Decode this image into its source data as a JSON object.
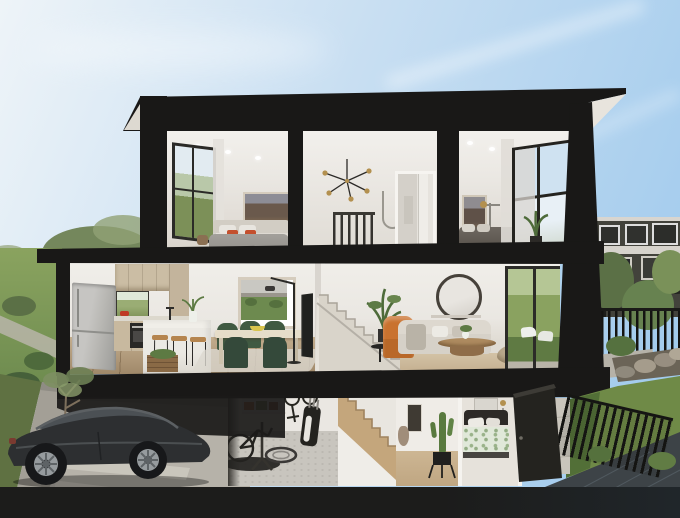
{
  "scene": {
    "type": "architectural-cutaway-render",
    "description": "Dollhouse cutaway render of a three-storey black-framed townhouse: two bedrooms and a stair landing upstairs, kitchen-dining and living room with staircase mid-level, and a garage with black sedan, bike workshop, hall and third bedroom at ground level; eucalyptus trees and driveway on the left, neighbouring dark townhouses, backyard, black slat fences and sloping lawn on the right under a clear blue sky.",
    "floors": [
      {
        "name": "upper",
        "rooms": [
          {
            "name": "main-bedroom",
            "objects": [
              "side-window",
              "landscape-artwork",
              "queen-bed",
              "white-pillows",
              "orange-accent-cushions",
              "ceiling-downlights",
              "sheer-curtain"
            ]
          },
          {
            "name": "stair-landing",
            "objects": [
              "sputnik-chandelier",
              "stair-balustrade",
              "towel-rail",
              "bathroom-doorway"
            ]
          },
          {
            "name": "second-bedroom",
            "objects": [
              "landscape-artwork",
              "brass-wall-lamp",
              "bed-dark-linen",
              "large-corner-window",
              "potted-plant",
              "sheer-curtain"
            ]
          }
        ]
      },
      {
        "name": "middle",
        "rooms": [
          {
            "name": "kitchen-dining",
            "objects": [
              "stainless-fridge",
              "timber-upper-cabinets",
              "garden-window-splashback",
              "wall-oven",
              "red-pot",
              "island-bench",
              "tap",
              "vase-of-greenery",
              "bar-stools",
              "produce-crate",
              "dining-table",
              "green-dining-chairs",
              "fruit-bowl",
              "park-artwork",
              "arc-floor-lamp",
              "wall-tv",
              "rug"
            ]
          },
          {
            "name": "living",
            "objects": [
              "staircase-up",
              "indoor-plant",
              "orange-armchair",
              "black-side-table",
              "sofa",
              "round-mirror",
              "console",
              "timber-coffee-table",
              "ottoman",
              "glass-slider-to-backyard",
              "outdoor-chairs-glimpse"
            ]
          }
        ]
      },
      {
        "name": "ground",
        "rooms": [
          {
            "name": "garage",
            "objects": [
              "storage-shelf-with-bins",
              "wall-hung-bikes",
              "golf-bag",
              "bike-on-repair-stand",
              "workshop-mat",
              "spare-wheel"
            ]
          },
          {
            "name": "stair-hall",
            "objects": [
              "timber-stairs",
              "framed-art",
              "ceramic-vase",
              "cactus-in-pot"
            ]
          },
          {
            "name": "third-bedroom",
            "objects": [
              "bed-green-patterned-bedding",
              "dark-headboard",
              "bedside-lamp"
            ]
          },
          {
            "name": "entry",
            "objects": [
              "open-black-door"
            ]
          }
        ]
      }
    ],
    "exterior": {
      "left": [
        "eucalyptus-trees",
        "garden-lawn",
        "shrubs",
        "footpath",
        "street",
        "driveway",
        "street-tree",
        "black-sedan-parked"
      ],
      "right": [
        "neighbour-townhouses",
        "pergola",
        "planter",
        "backyard-greenery",
        "black-slat-fence",
        "rock-garden",
        "sloping-lawn",
        "timber-side-path",
        "concrete-retaining-wall"
      ],
      "sky": "clear blue, pale at horizon, faint cloud streaks"
    }
  },
  "palette": {
    "sky-top": "#9cc8ec",
    "sky-mid": "#c9dff2",
    "sky-low": "#eef4f8",
    "structure": "#191817",
    "soffit": "#e8e4dd",
    "wall": "#eae7e2",
    "wall-dim": "#ded9d2",
    "ceiling": "#f2f0ec",
    "floor-timber": "#c3ae8e",
    "floor-dark": "#a0896a",
    "carpet": "#d8d4cb",
    "lawn": "#7d9858",
    "lawn-dark": "#5a7540",
    "lawn-right": "#6f8a47",
    "tree": "#74875c",
    "tree-dark": "#5b7046",
    "trunk": "#8d7c66",
    "driveway": "#b6b2a9",
    "roadside": "#a39f96",
    "band": "#1c1c1b",
    "deck": "#3d4347",
    "car": "#2d2f31",
    "car-glass": "#4b5054",
    "rim": "#969b9e",
    "fridge": "#b9b8b4",
    "cabinet": "#cbbda4",
    "island": "#ebe9e3",
    "counter": "#dcd8cd",
    "oven": "#292826",
    "green-chair": "#405a42",
    "green-chair-dark": "#34493a",
    "table": "#e6ddc9",
    "wood": "#ad8a5f",
    "sofa": "#d6d1c8",
    "orange": "#c9722f",
    "pouf": "#b7a78b",
    "mirror-frame": "#46413a",
    "art-frame": "#d5ccbd",
    "park": "#6d8a4f",
    "art-dark": "#6a594c",
    "brass": "#b3904f",
    "bed-gray": "#96938e",
    "bed-dark": "#57524b",
    "pillow": "#e8e5df",
    "accent": "#c4502e",
    "stair": "#d9d4ca",
    "stair-timber": "#c4a67c",
    "fence": "#141412",
    "concrete": "#c9c5bc",
    "neighbor": "#42423b",
    "frame-dark": "#24231f",
    "plant": "#4e6b3a",
    "garage-floor": "#c8c5be",
    "mat": "#232220",
    "duvet-green": "#e0e8d9"
  }
}
